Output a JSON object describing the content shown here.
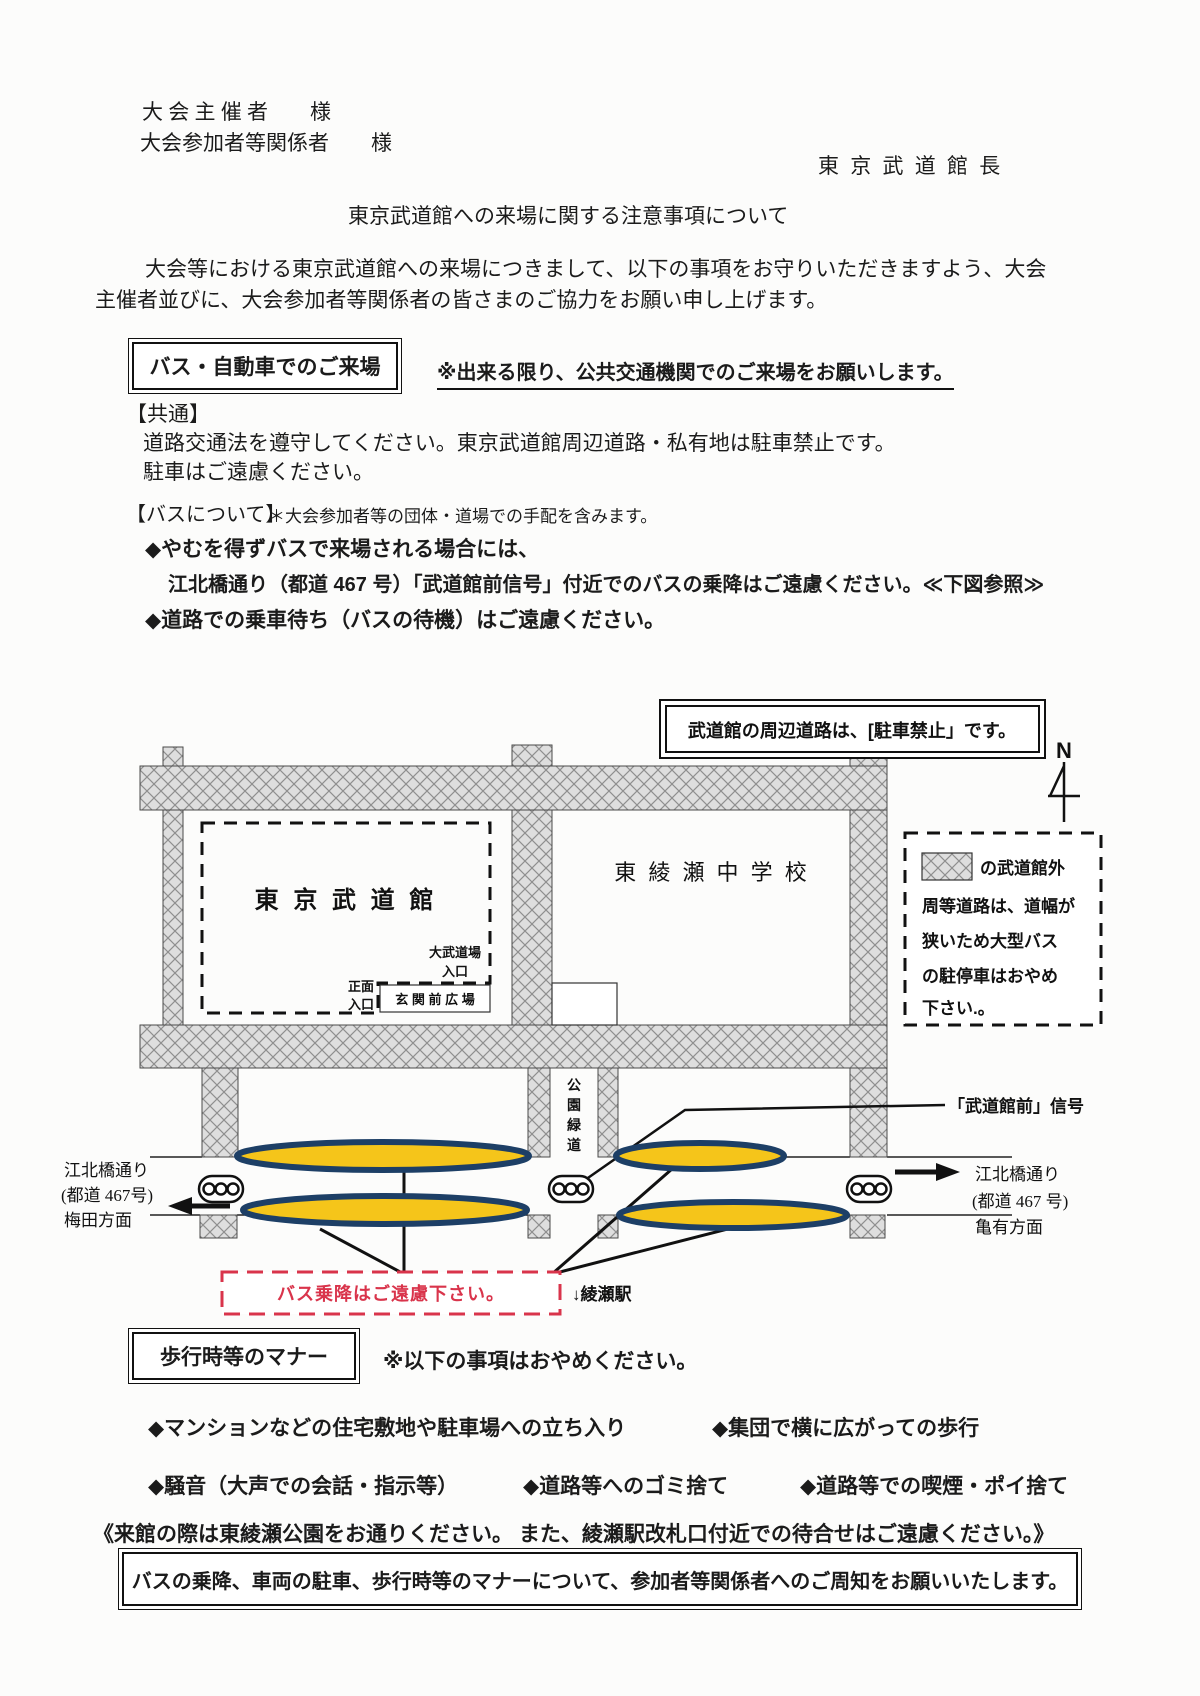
{
  "header": {
    "recipient1": "大 会 主 催 者　　様",
    "recipient2": "大会参加者等関係者　　様",
    "sender": "東 京 武 道 館 長",
    "title": "東京武道館への来場に関する注意事項について",
    "intro_line1": "大会等における東京武道館への来場につきまして、以下の事項をお守りいただきますよう、大会",
    "intro_line2": "主催者並びに、大会参加者等関係者の皆さまのご協力をお願い申し上げます。"
  },
  "bus_section": {
    "heading": "バス・自動車でのご来場",
    "note": "※出来る限り、公共交通機関でのご来場をお願いします。",
    "common_label": "【共通】",
    "common_line1": "道路交通法を遵守してください。東京武道館周辺道路・私有地は駐車禁止です。",
    "common_line2": "駐車はご遠慮ください。",
    "about_label": "【バスについて】",
    "about_note": "＊大会参加者等の団体・道場での手配を含みます。",
    "bullet1": "◆やむを得ずバスで来場される場合には、",
    "bullet1_detail": "江北橋通り（都道 467 号）「武道館前信号」付近でのバスの乗降はご遠慮ください。≪下図参照≫",
    "bullet2": "◆道路での乗車待ち（バスの待機）はご遠慮ください。"
  },
  "map": {
    "no_parking_notice": "武道館の周辺道路は、[駐車禁止」です。",
    "compass_n": "N",
    "budokan_label": "東 京 武 道 館",
    "school_label": "東 綾 瀬 中 学 校",
    "dai_budojo_line1": "大武道場",
    "dai_budojo_line2": "入口",
    "shomen_line1": "正面",
    "shomen_line2": "入口",
    "genkan_label": "玄 関 前 広 場",
    "green_way": [
      "公",
      "園",
      "緑",
      "道"
    ],
    "legend": [
      "の武道館外",
      "周等道路は、道幅が",
      "狭いため大型バス",
      "の駐停車はおやめ",
      "下さい.。"
    ],
    "signal_label": "「武道館前」信号",
    "left_road_line1": "江北橋通り",
    "left_road_line2": "(都道 467号)",
    "left_road_line3": "梅田方面",
    "right_road_line1": "江北橋通り",
    "right_road_line2": "(都道 467 号)",
    "right_road_line3": "亀有方面",
    "no_bus_notice": "バス乗降はご遠慮下さい。",
    "ayase_station": "↓綾瀬駅"
  },
  "manner_section": {
    "heading": "歩行時等のマナー",
    "note": "※以下の事項はおやめください。",
    "bullets_row1": [
      "◆マンションなどの住宅敷地や駐車場への立ち入り",
      "◆集団で横に広がっての歩行"
    ],
    "bullets_row2": [
      "◆騒音（大声での会話・指示等）",
      "◆道路等へのゴミ捨て",
      "◆道路等での喫煙・ポイ捨て"
    ],
    "park_note": "《来館の際は東綾瀬公園をお通りください。 また、綾瀬駅改札口付近での待合せはご遠慮ください。》",
    "footer_notice": "バスの乗降、車両の駐車、歩行時等のマナーについて、参加者等関係者へのご周知をお願いいたします。"
  },
  "colors": {
    "accent-red": "#d9344b",
    "oval-yellow": "#f5c51a",
    "oval-border": "#1d3f66",
    "road-fill": "#dedede",
    "road-hatch": "#8f8f8f",
    "ink": "#1b1b1b",
    "paper": "#fcfcfb"
  }
}
